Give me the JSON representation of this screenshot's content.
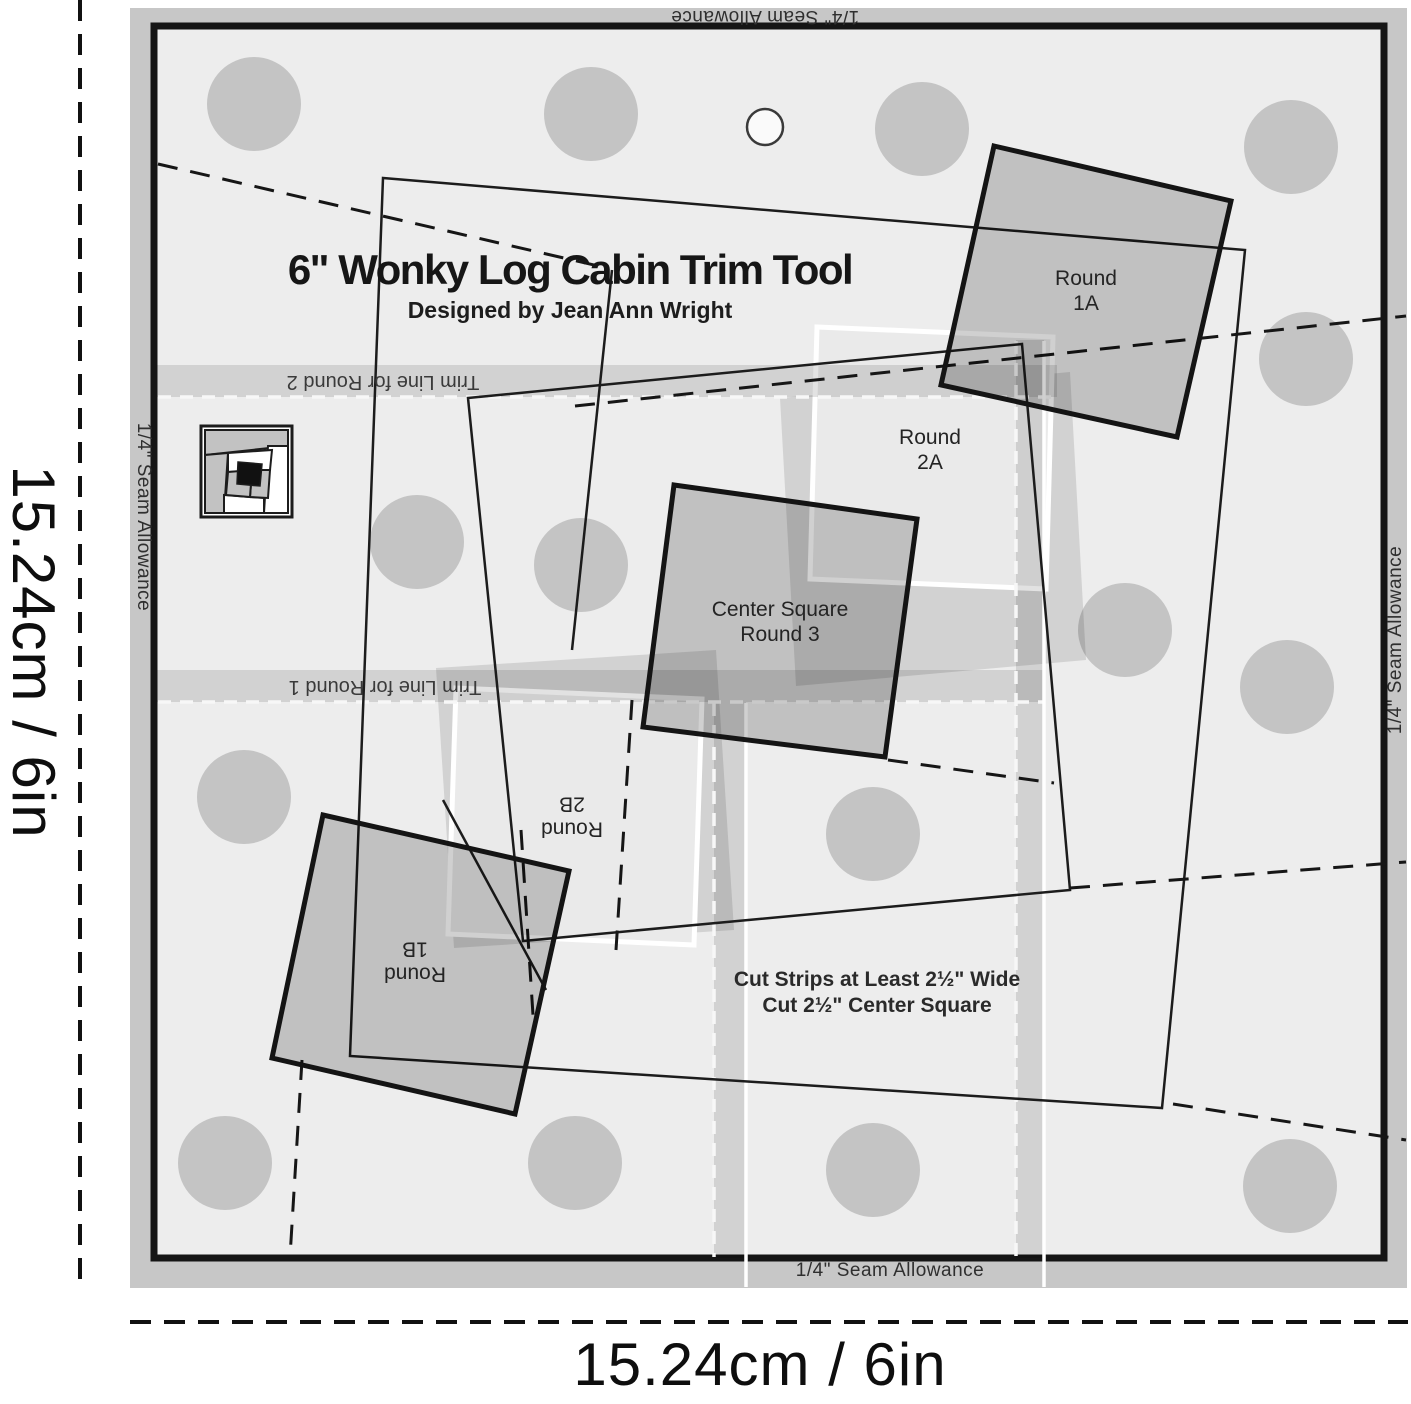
{
  "header": {
    "title": "6\" Wonky Log Cabin Trim Tool",
    "subtitle": "Designed by Jean Ann Wright"
  },
  "seam": {
    "label": "1/4\" Seam Allowance"
  },
  "trim": {
    "round2": "Trim Line for Round 2",
    "round1": "Trim Line for Round 1"
  },
  "patches": {
    "r1a_1": "Round",
    "r1a_2": "1A",
    "r2a_1": "Round",
    "r2a_2": "2A",
    "c3_1": "Center Square",
    "c3_2": "Round 3",
    "r2b_1": "Round",
    "r2b_2": "2B",
    "r1b_1": "Round",
    "r1b_2": "1B"
  },
  "instructions": {
    "line1": "Cut Strips at Least 2½\" Wide",
    "line2": "Cut 2½\" Center Square"
  },
  "dimensions": {
    "left": "15.24cm / 6in",
    "bottom": "15.24cm / 6in"
  },
  "colors": {
    "template_bg": "#ededed",
    "seam_band": "#c7c7c7",
    "dot": "#c4c4c4",
    "patch_fill": "#b9b9b9",
    "keep_zone": "#eaeaea",
    "line": "#1c1c1c"
  }
}
